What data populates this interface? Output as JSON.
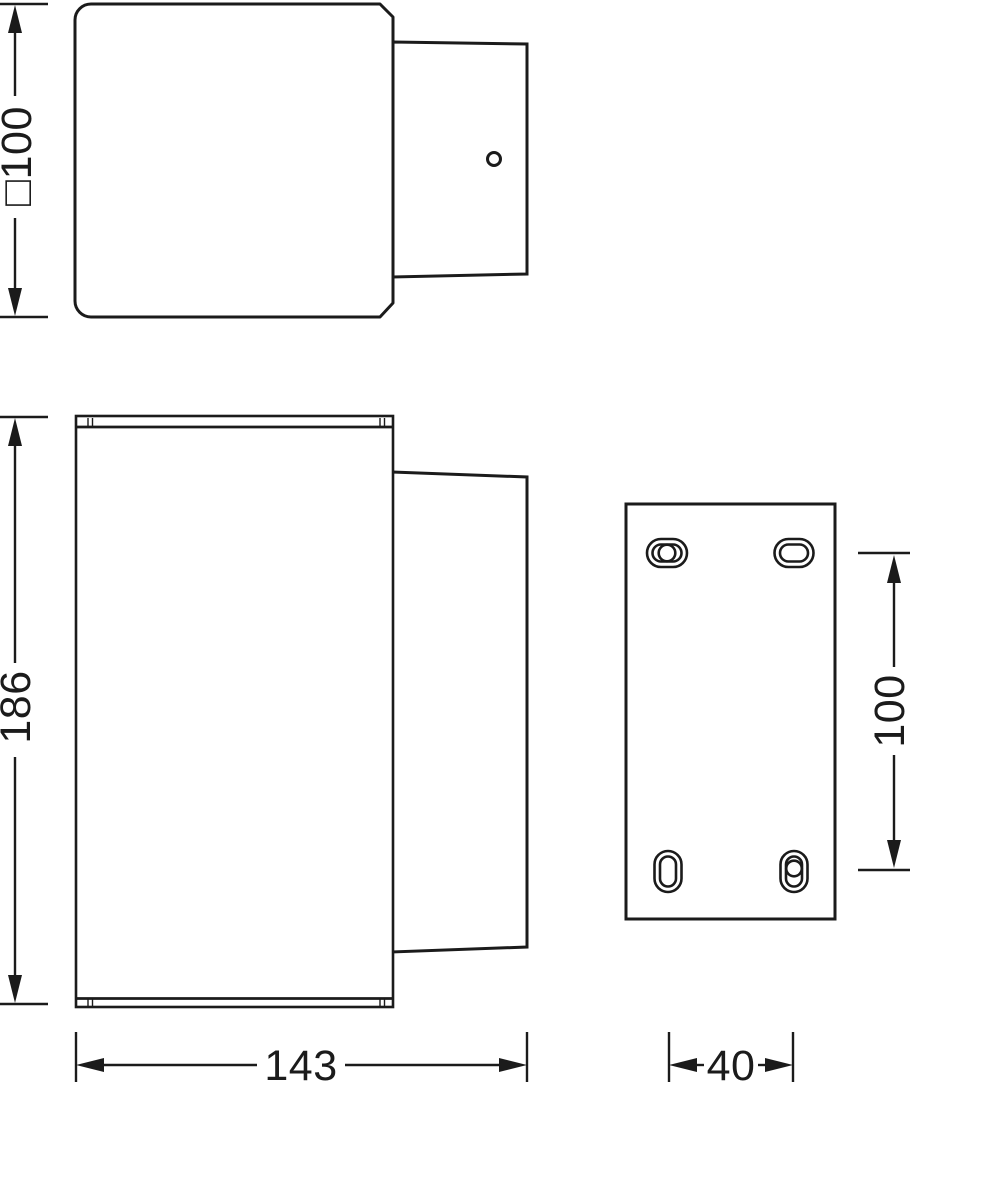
{
  "drawing": {
    "background": "#ffffff",
    "ink_color": "#1b1b1b",
    "dimensions": {
      "top_size": {
        "label": "□100",
        "value": 100
      },
      "height": {
        "label": "186",
        "value": 186
      },
      "width": {
        "label": "143",
        "value": 143
      },
      "plate_hole_spacing_vertical": {
        "label": "100",
        "value": 100
      },
      "plate_hole_spacing_horizontal": {
        "label": "40",
        "value": 40
      }
    }
  }
}
